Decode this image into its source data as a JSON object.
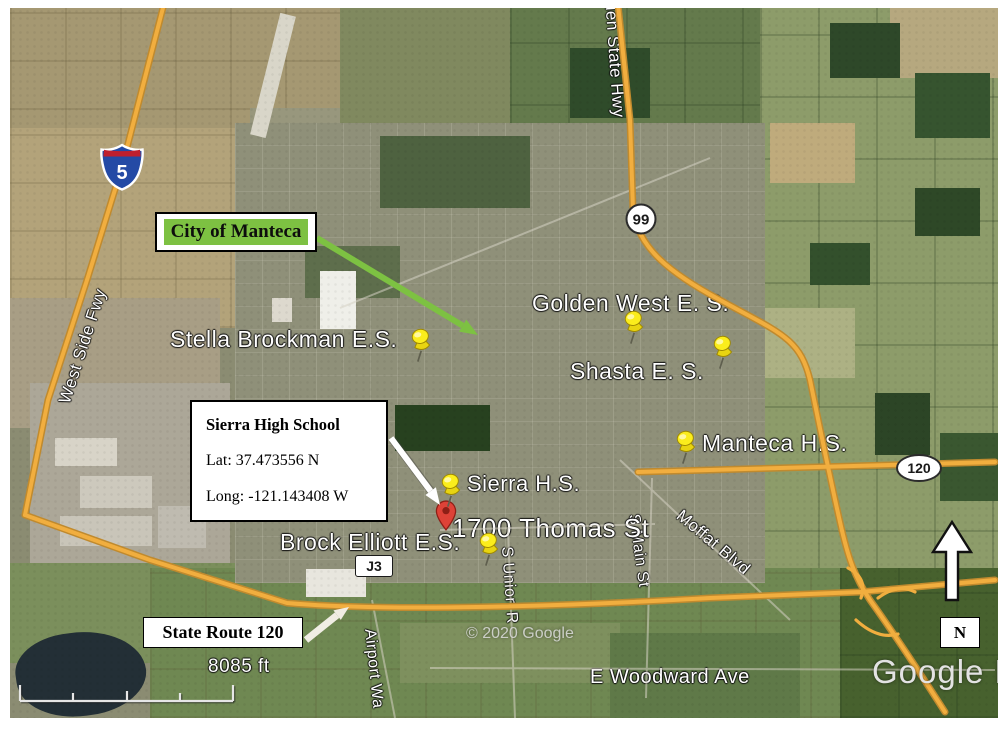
{
  "map": {
    "attribution": "© 2020 Google",
    "watermark": "Google Ea",
    "scale_label": "8085 ft",
    "compass_letter": "N"
  },
  "callouts": {
    "city_of_manteca": {
      "label": "City of Manteca"
    },
    "sierra_high_school": {
      "title": "Sierra High School",
      "latitude": "Lat: 37.473556 N",
      "longitude": "Long: -121.143408 W"
    },
    "state_route_120": {
      "label": "State Route 120"
    }
  },
  "schools": {
    "stella_brockman": "Stella Brockman E.S.",
    "golden_west": "Golden West E. S.",
    "shasta": "Shasta E. S.",
    "manteca_hs": "Manteca H.S.",
    "sierra_hs": "Sierra H.S.",
    "brock_elliott": "Brock Elliott E.S.",
    "address_1700_thomas": "1700 Thomas St"
  },
  "roads": {
    "golden_state_hwy": "lden State Hwy",
    "west_side_fwy": "West Side Fwy",
    "s_union_rd": "S Union R",
    "s_main_st": "S Main St",
    "moffat_blvd": "Moffat Blvd",
    "airport_way": "Airport Wa",
    "e_woodward_ave": "E Woodward Ave"
  },
  "shields": {
    "interstate_5": "5",
    "sr_99": "99",
    "sr_120": "120",
    "county_j3": "J3"
  },
  "colors": {
    "highway_yellow": "#F1AE3F",
    "annotation_green": "#7DC142",
    "pushpin_yellow": "#FBED1C",
    "marker_red": "#DE4237"
  }
}
